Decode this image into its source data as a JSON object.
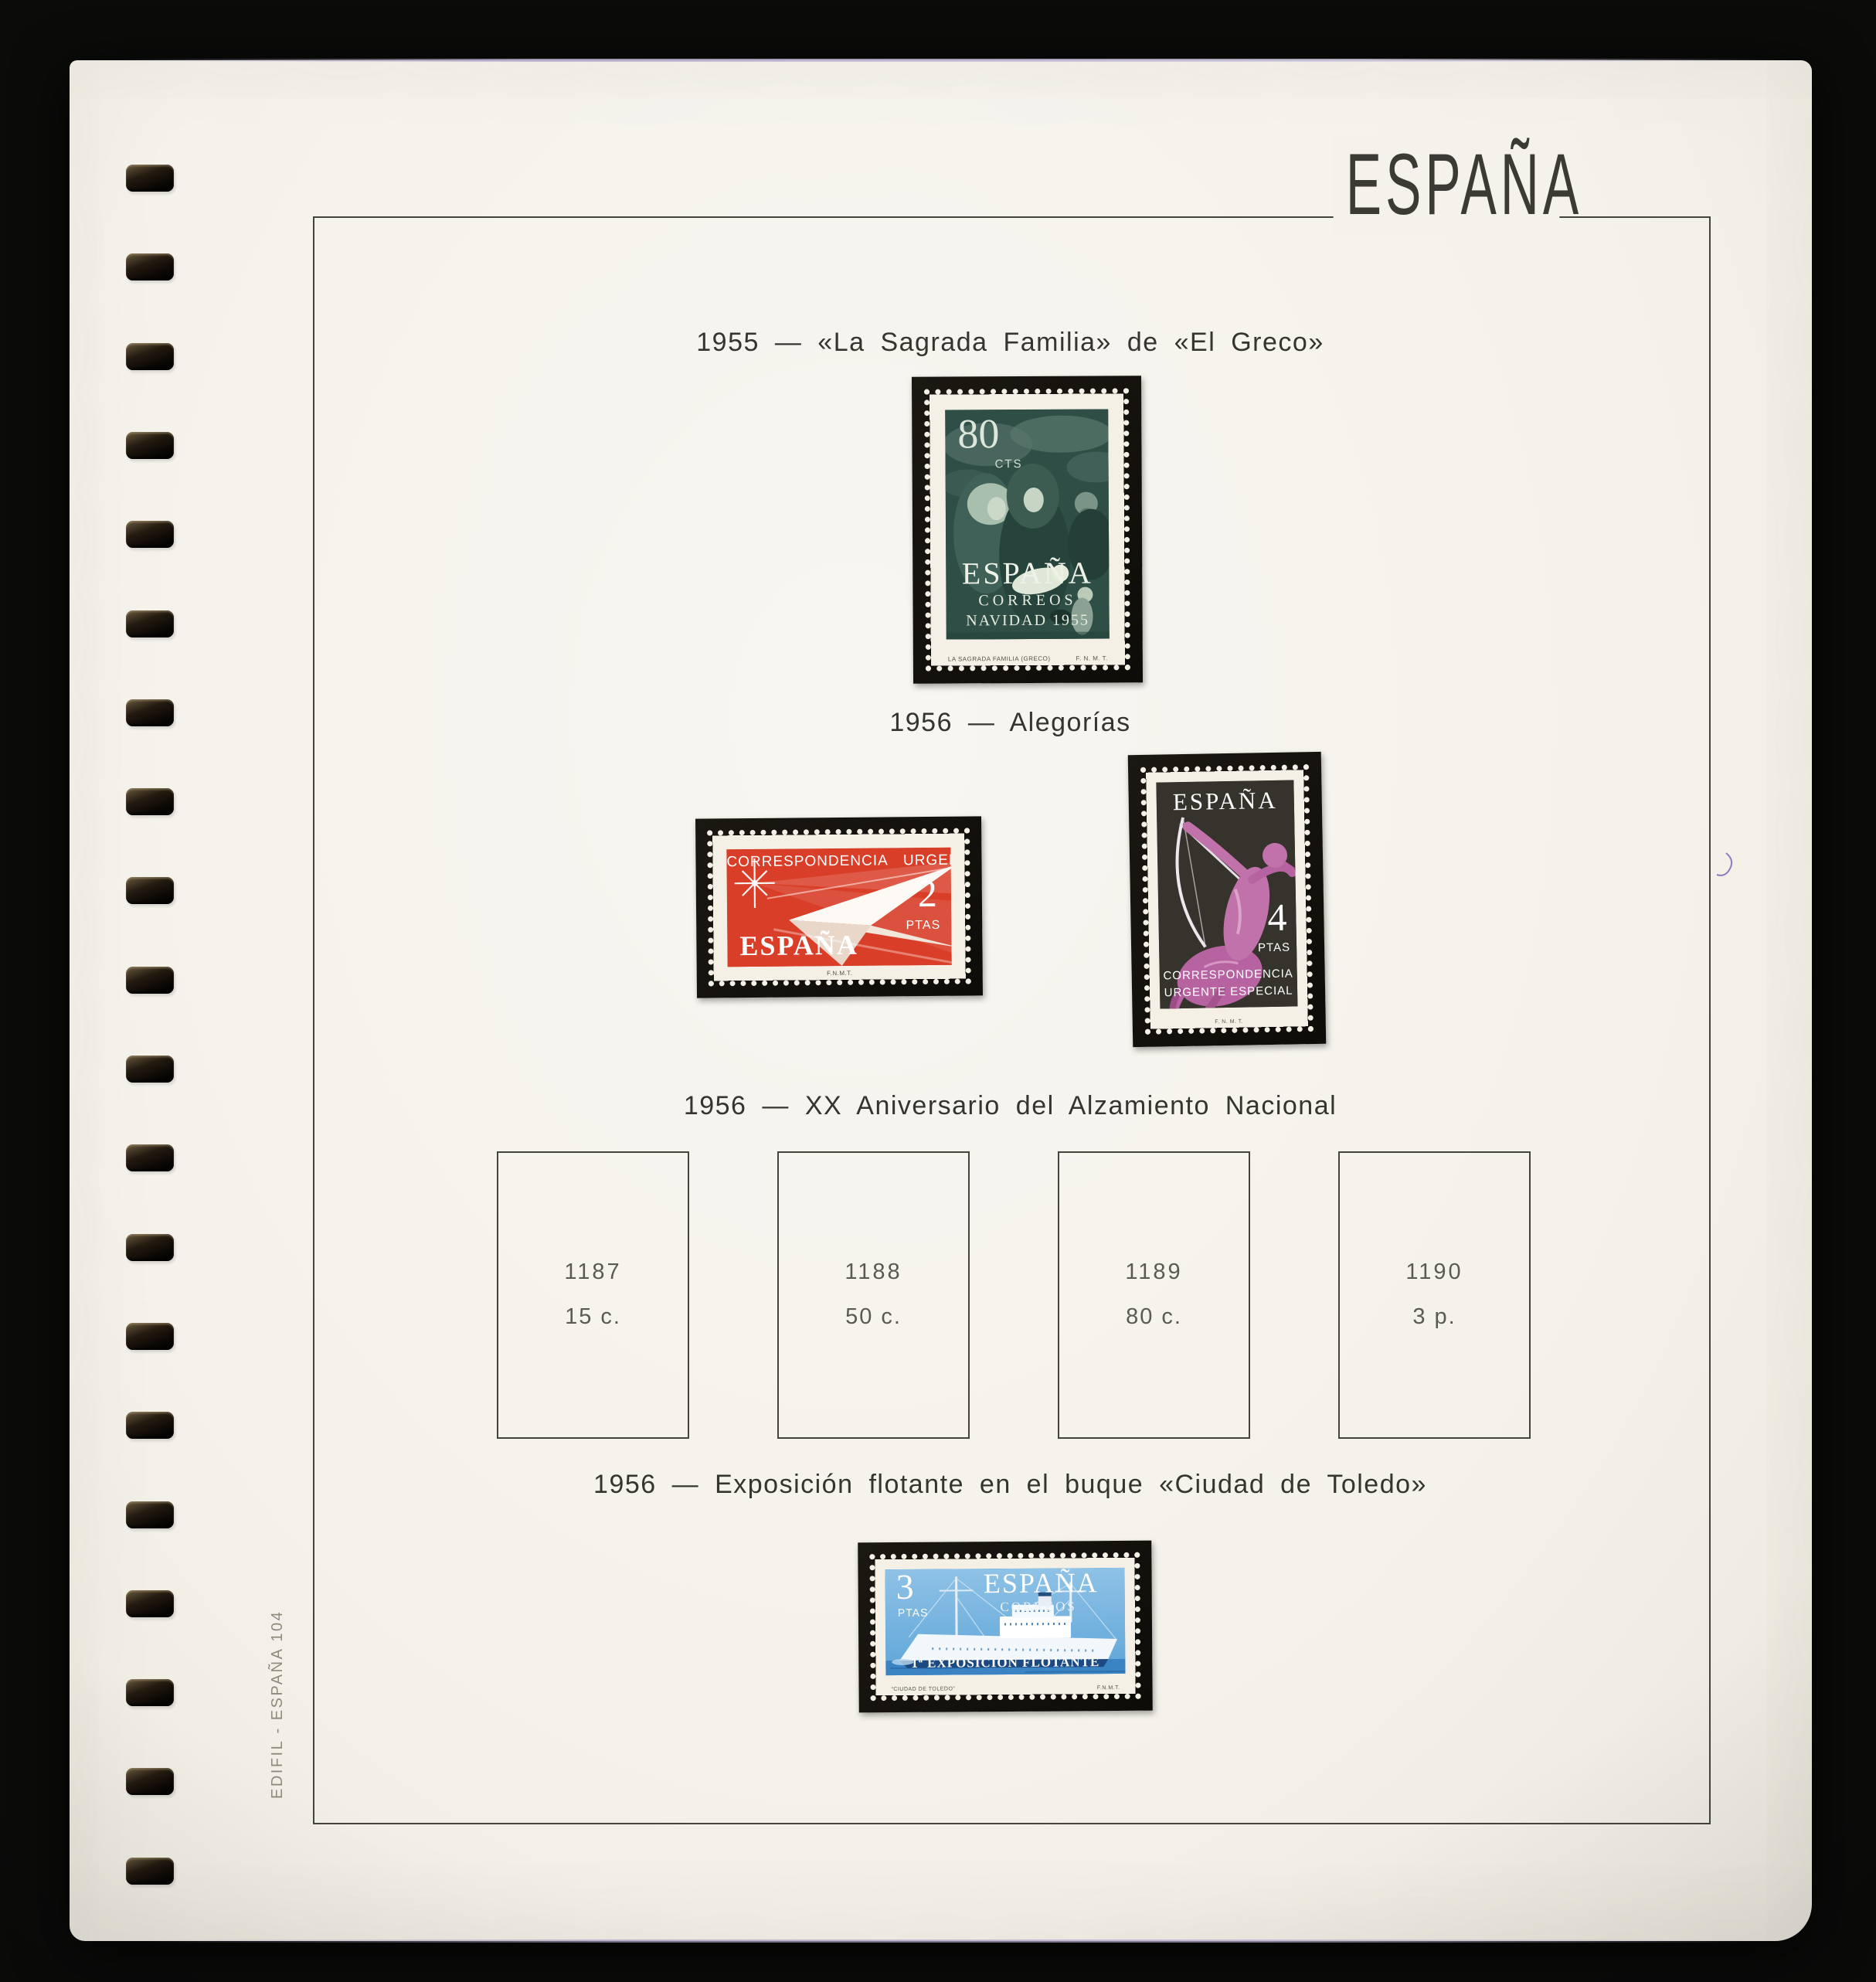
{
  "page": {
    "title": "ESPAÑA",
    "edge_label": "EDIFIL - ESPAÑA 104"
  },
  "binder": {
    "hole_count": 20
  },
  "sections": [
    {
      "heading": "1955 — «La Sagrada Familia» de «El Greco»"
    },
    {
      "heading": "1956 — Alegorías"
    },
    {
      "heading": "1956 — XX Aniversario del Alzamiento Nacional"
    },
    {
      "heading": "1956 — Exposición flotante en el buque «Ciudad de Toledo»"
    }
  ],
  "stamps": {
    "navidad": {
      "value": "80",
      "unit": "CTS",
      "country": "ESPAÑA",
      "line2": "CORREOS",
      "line3": "NAVIDAD 1955",
      "imprint_left": "LA SAGRADA FAMILIA (GRECO)",
      "imprint_right": "F. N. M. T."
    },
    "urgente": {
      "header": "CORRESPONDENCIA URGENTE",
      "value": "2",
      "unit": "PTAS",
      "country": "ESPAÑA",
      "imprint": "F.N.M.T."
    },
    "especial": {
      "country": "ESPAÑA",
      "value": "4",
      "unit": "PTAS",
      "bottom1": "CORRESPONDENCIA",
      "bottom2": "URGENTE ESPECIAL",
      "imprint": "F. N. M. T."
    },
    "flotante": {
      "value": "3",
      "unit": "PTAS",
      "country": "ESPAÑA",
      "line2": "CORREOS",
      "bottom": "1ª EXPOSICIÓN FLOTANTE",
      "imprint_left": "“CIUDAD DE TOLEDO”",
      "imprint_right": "F.N.M.T."
    }
  },
  "placeholders": [
    {
      "number": "1187",
      "value": "15 c."
    },
    {
      "number": "1188",
      "value": "50 c."
    },
    {
      "number": "1189",
      "value": "80 c."
    },
    {
      "number": "1190",
      "value": "3 p."
    }
  ],
  "colors": {
    "photo_bg": "#0b0b0a",
    "page_bg": "#f4f2ea",
    "frame_line": "#45443c",
    "mount": "#0e0c08",
    "stamp_paper": "#f4f0e5",
    "navidad_green": "#2e4e46",
    "urgente_red": "#d93e28",
    "especial_dark": "#35332b",
    "especial_magenta": "#b763a2",
    "flotante_blue": "#4a95d0",
    "placeholder_text": "#5b5a50",
    "edge_text": "#8e8a7c"
  }
}
